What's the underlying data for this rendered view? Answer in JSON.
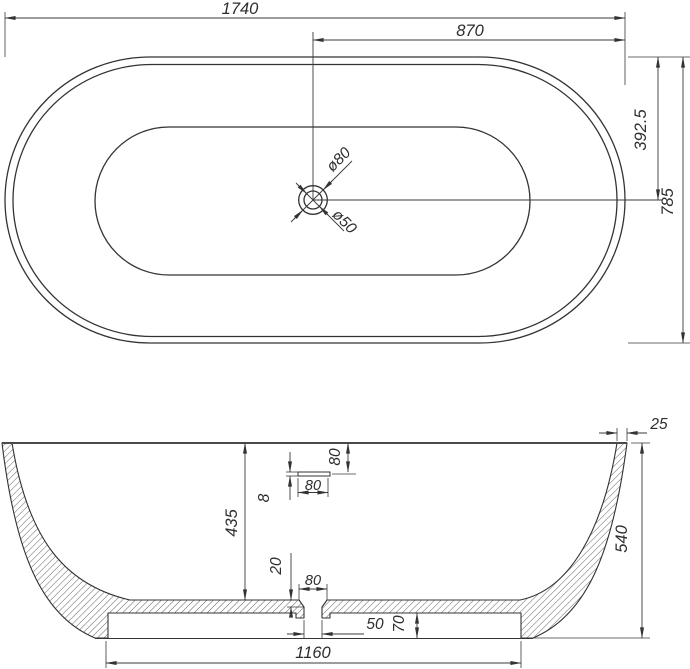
{
  "drawing": {
    "background_color": "#ffffff",
    "line_color": "#333333",
    "dimension_line_color": "#3a3a3a"
  },
  "top_view": {
    "total_length": "1740",
    "half_length": "870",
    "half_width": "392.5",
    "total_width": "785",
    "drain_outer_diameter": "ø80",
    "drain_inner_diameter": "ø50"
  },
  "section_view": {
    "inner_depth": "435",
    "overall_height": "540",
    "rim_wall_thickness": "25",
    "overflow_offset_from_rim": "80",
    "overflow_slot_height": "8",
    "overflow_slot_width": "80",
    "drain_recess_depth": "20",
    "drain_recess_width": "80",
    "drain_hole_width": "50",
    "base_recess_height": "70",
    "base_recess_width": "1160"
  }
}
